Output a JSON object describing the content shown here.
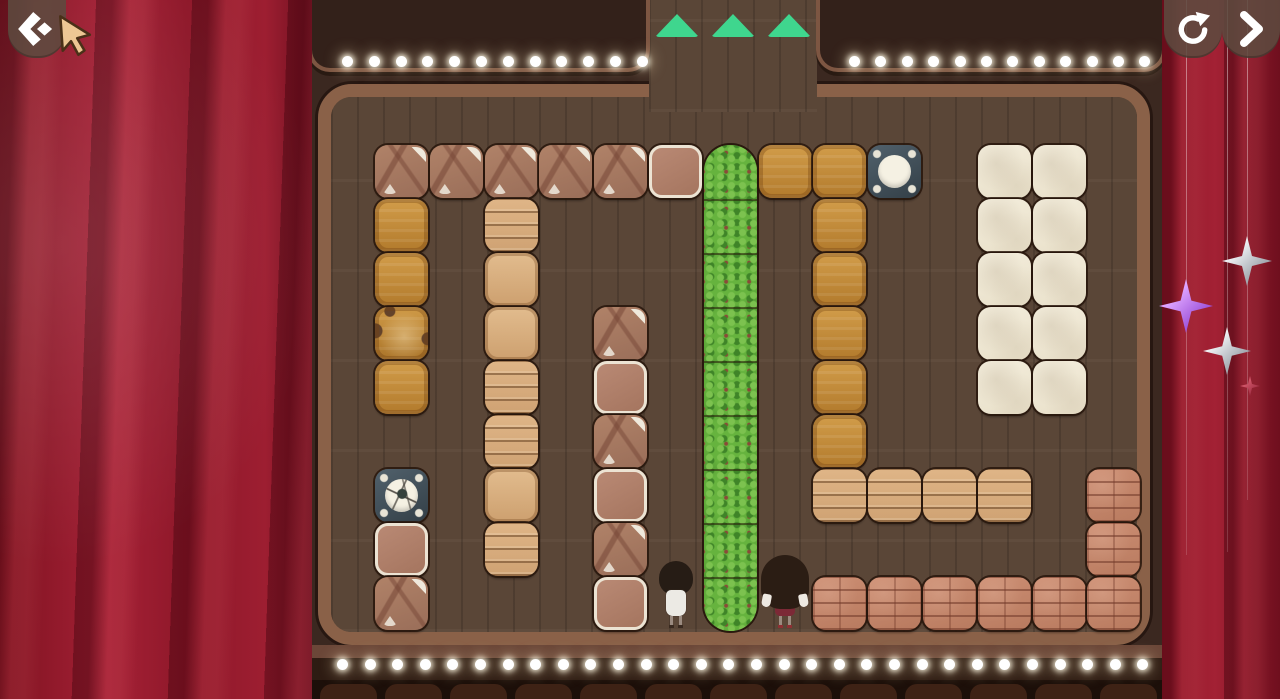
{
  "app": {
    "name": "block-push-puzzle-stage",
    "scene": "theater-stage-level"
  },
  "nav": {
    "back_button": {
      "icon": "chevron-left-diamond",
      "label": "back"
    },
    "restart_button": {
      "icon": "restart-circular-arrow",
      "label": "restart-level"
    },
    "next_button": {
      "icon": "chevron-right",
      "label": "next"
    }
  },
  "progress": {
    "triangle_count": 3,
    "triangle_color": "#3fd68e"
  },
  "board": {
    "cols": 14,
    "rows": 9,
    "origin_x": 375,
    "origin_y": 145,
    "cell_w": 54.8,
    "cell_h": 54,
    "legend": {
      "cracked": "cracked clay crate",
      "pink": "smooth clay crate with white rim",
      "amber": "amber wooden crate",
      "amber_damaged": "damaged amber wooden crate",
      "tan_planks": "tan plank crate",
      "tan_smooth": "smooth tan crate",
      "white": "white wooden crate",
      "brick": "brick block",
      "slate": "slate button target",
      "slate_cracked": "cracked slate button target"
    },
    "hedge": {
      "col": 6,
      "row_start": 0,
      "cells": 9
    },
    "blocks": [
      {
        "c": 0,
        "r": 0,
        "t": "cracked"
      },
      {
        "c": 1,
        "r": 0,
        "t": "cracked"
      },
      {
        "c": 2,
        "r": 0,
        "t": "cracked"
      },
      {
        "c": 3,
        "r": 0,
        "t": "cracked"
      },
      {
        "c": 4,
        "r": 0,
        "t": "cracked"
      },
      {
        "c": 5,
        "r": 0,
        "t": "pink"
      },
      {
        "c": 7,
        "r": 0,
        "t": "amber"
      },
      {
        "c": 8,
        "r": 0,
        "t": "amber"
      },
      {
        "c": 9,
        "r": 0,
        "t": "slate"
      },
      {
        "c": 11,
        "r": 0,
        "t": "white"
      },
      {
        "c": 12,
        "r": 0,
        "t": "white"
      },
      {
        "c": 0,
        "r": 1,
        "t": "amber"
      },
      {
        "c": 2,
        "r": 1,
        "t": "tan_planks"
      },
      {
        "c": 8,
        "r": 1,
        "t": "amber"
      },
      {
        "c": 11,
        "r": 1,
        "t": "white"
      },
      {
        "c": 12,
        "r": 1,
        "t": "white"
      },
      {
        "c": 0,
        "r": 2,
        "t": "amber"
      },
      {
        "c": 2,
        "r": 2,
        "t": "tan_smooth"
      },
      {
        "c": 8,
        "r": 2,
        "t": "amber"
      },
      {
        "c": 11,
        "r": 2,
        "t": "white"
      },
      {
        "c": 12,
        "r": 2,
        "t": "white"
      },
      {
        "c": 0,
        "r": 3,
        "t": "amber_damaged"
      },
      {
        "c": 2,
        "r": 3,
        "t": "tan_smooth"
      },
      {
        "c": 4,
        "r": 3,
        "t": "cracked"
      },
      {
        "c": 8,
        "r": 3,
        "t": "amber"
      },
      {
        "c": 11,
        "r": 3,
        "t": "white"
      },
      {
        "c": 12,
        "r": 3,
        "t": "white"
      },
      {
        "c": 0,
        "r": 4,
        "t": "amber"
      },
      {
        "c": 2,
        "r": 4,
        "t": "tan_planks"
      },
      {
        "c": 4,
        "r": 4,
        "t": "pink"
      },
      {
        "c": 8,
        "r": 4,
        "t": "amber"
      },
      {
        "c": 11,
        "r": 4,
        "t": "white"
      },
      {
        "c": 12,
        "r": 4,
        "t": "white"
      },
      {
        "c": 2,
        "r": 5,
        "t": "tan_planks"
      },
      {
        "c": 4,
        "r": 5,
        "t": "cracked"
      },
      {
        "c": 8,
        "r": 5,
        "t": "amber"
      },
      {
        "c": 0,
        "r": 6,
        "t": "slate_cracked"
      },
      {
        "c": 2,
        "r": 6,
        "t": "tan_smooth"
      },
      {
        "c": 4,
        "r": 6,
        "t": "pink"
      },
      {
        "c": 8,
        "r": 6,
        "t": "tan_planks"
      },
      {
        "c": 9,
        "r": 6,
        "t": "tan_planks"
      },
      {
        "c": 10,
        "r": 6,
        "t": "tan_planks"
      },
      {
        "c": 11,
        "r": 6,
        "t": "tan_planks"
      },
      {
        "c": 13,
        "r": 6,
        "t": "brick"
      },
      {
        "c": 0,
        "r": 7,
        "t": "pink"
      },
      {
        "c": 2,
        "r": 7,
        "t": "tan_planks"
      },
      {
        "c": 4,
        "r": 7,
        "t": "cracked"
      },
      {
        "c": 13,
        "r": 7,
        "t": "brick"
      },
      {
        "c": 0,
        "r": 8,
        "t": "cracked"
      },
      {
        "c": 4,
        "r": 8,
        "t": "pink"
      },
      {
        "c": 8,
        "r": 8,
        "t": "brick"
      },
      {
        "c": 9,
        "r": 8,
        "t": "brick"
      },
      {
        "c": 10,
        "r": 8,
        "t": "brick"
      },
      {
        "c": 11,
        "r": 8,
        "t": "brick"
      },
      {
        "c": 12,
        "r": 8,
        "t": "brick"
      },
      {
        "c": 13,
        "r": 8,
        "t": "brick"
      }
    ],
    "characters": [
      {
        "type": "girl-small",
        "c": 5,
        "r": 8,
        "hair": "#261c15",
        "dress": "#eceae4"
      },
      {
        "type": "girl-big",
        "c": 7,
        "r": 8,
        "hair": "#2b1d14",
        "dress": "#7c2936"
      }
    ]
  },
  "marquee": {
    "bulb_color": "#ffffff",
    "top_left": {
      "x": 342,
      "y": 56,
      "count": 12,
      "spacing": 26.8
    },
    "top_right": {
      "x": 849,
      "y": 56,
      "count": 12,
      "spacing": 26.4
    },
    "bottom": {
      "x": 337,
      "y": 659,
      "count": 30,
      "spacing": 27.6
    }
  },
  "seats": {
    "count": 13,
    "x": 320,
    "gap": 65
  },
  "ornaments": {
    "strings": [
      {
        "x": 1186,
        "length": 555
      },
      {
        "x": 1227,
        "length": 552
      },
      {
        "x": 1247,
        "length": 500
      }
    ],
    "stars": [
      {
        "x": 1247,
        "y": 261,
        "size": 50,
        "color1": "#eef0f3",
        "color2": "#9aa0a8"
      },
      {
        "x": 1186,
        "y": 306,
        "size": 54,
        "color1": "#dfa6ff",
        "color2": "#9a4fd8"
      },
      {
        "x": 1227,
        "y": 351,
        "size": 48,
        "color1": "#eef0f3",
        "color2": "#9aa0a8"
      },
      {
        "x": 1250,
        "y": 386,
        "size": 20,
        "color1": "#d4596c",
        "color2": "#a12f44"
      }
    ]
  },
  "colors": {
    "curtain": "#971c2e",
    "stage_bg": "#3b2820",
    "marquee_panel": "#33211a",
    "marquee_trim": "#7d5642",
    "board_frame": "#8a6148",
    "floor": "#5d4839",
    "hedge_green": "#55a035",
    "triangle_green": "#3fd68e"
  }
}
